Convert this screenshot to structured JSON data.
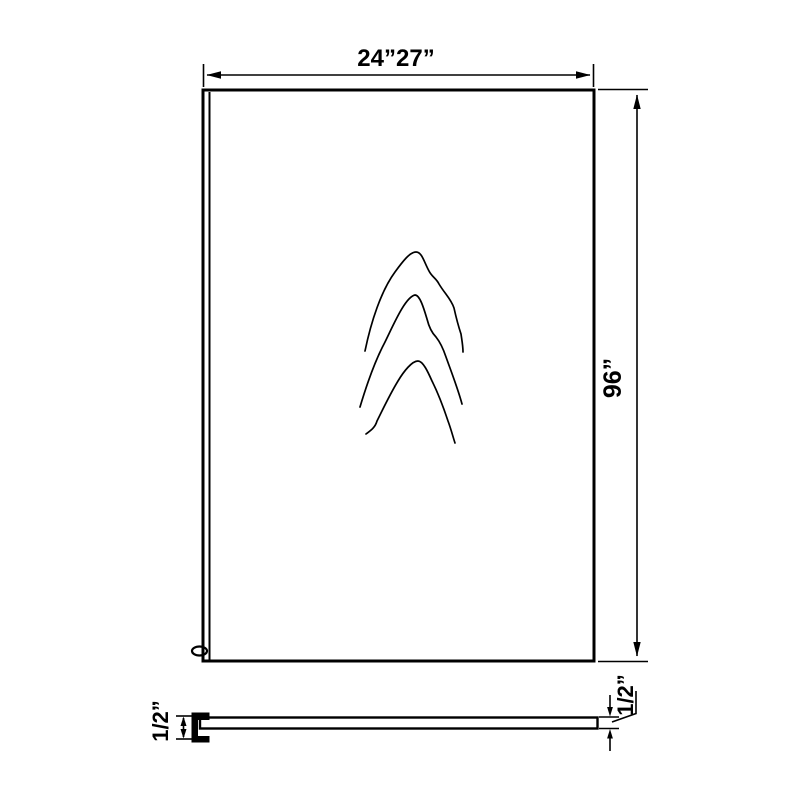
{
  "diagram": {
    "background_color": "#ffffff",
    "line_color": "#000000",
    "dimensions": {
      "width": "24”27”",
      "height": "96”",
      "thickness_left": "1/2”",
      "thickness_right": "1/2”"
    }
  }
}
